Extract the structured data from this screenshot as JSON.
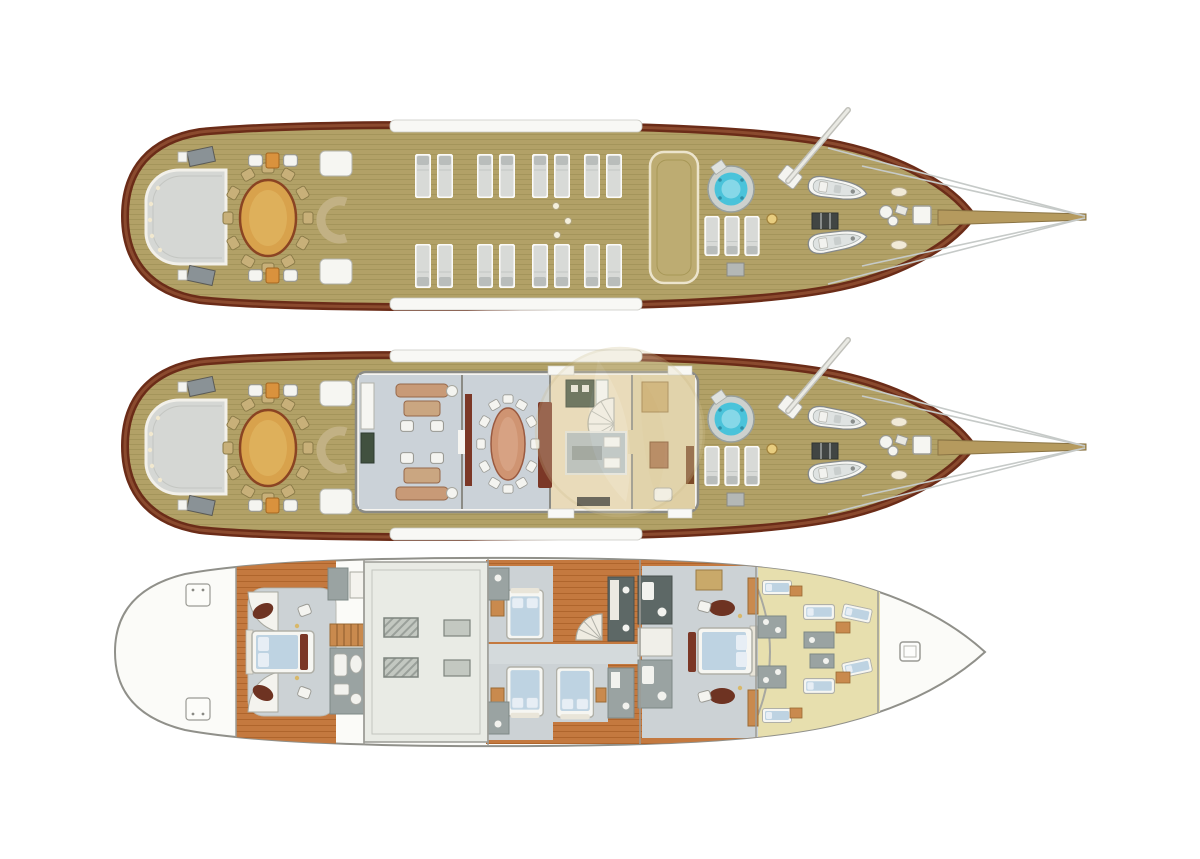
{
  "document": {
    "kind": "yacht-deck-plan-illustration",
    "background": "#ffffff",
    "decks": [
      {
        "id": "sun-deck",
        "features": [
          "stern-sun-pad",
          "alfresco-dining-table",
          "dining-chairs",
          "deck-seating-groups",
          "boarding-pads",
          "sun-lounger-rows",
          "skylight-panel",
          "jacuzzi",
          "sun-pads",
          "windlass-dot",
          "mast",
          "tenders",
          "deck-hatch",
          "bow-windlass",
          "bow-hatch",
          "bowsprit",
          "rigging-lines"
        ]
      },
      {
        "id": "main-deck",
        "features": [
          "stern-sun-pad",
          "alfresco-dining-table",
          "dining-chairs",
          "deck-seating-groups",
          "boarding-pads",
          "salon-lounge",
          "tv-cabinet",
          "interior-dining-table",
          "dining-benches",
          "galley",
          "spiral-staircase",
          "dinette",
          "pantry-lobby",
          "jacuzzi",
          "sun-pads",
          "mast",
          "tenders",
          "deck-hatch",
          "bow-windlass",
          "bowsprit",
          "rigging-lines"
        ]
      },
      {
        "id": "lower-deck",
        "features": [
          "lazarette-hatches",
          "master-cabin",
          "master-bed",
          "master-bathroom",
          "staircase",
          "engine-room",
          "engine-blocks",
          "guest-cabins",
          "guest-beds",
          "guest-bathrooms",
          "spiral-staircase",
          "corridor",
          "vip-cabin",
          "vip-bed",
          "vip-bathrooms",
          "crew-quarters",
          "crew-bunks",
          "crew-bathrooms",
          "forepeak-hatch"
        ]
      }
    ],
    "watermark": "sail-logo"
  },
  "counts": {
    "sun_loungers": 16,
    "dining_chairs_exterior": 12,
    "dining_chairs_interior": 12,
    "tenders_per_deck": 2,
    "jacuzzis": 2,
    "guest_beds": 3,
    "crew_bunks": 6,
    "engine_blocks": 4
  },
  "palette": {
    "teak": "#b2a167",
    "teak_line": "#998a52",
    "hull_trim": "#6b2c18",
    "hull_trim_light": "#8a4a2e",
    "white_structure": "#f6f5f1",
    "outline_gray": "#8b8b85",
    "stern_pad": "#d5d7d4",
    "table_gold": "#d8a24c",
    "table_rim": "#8a4423",
    "chair_tan": "#c8b079",
    "chair_white": "#f4f4f0",
    "accent_orange": "#d9923d",
    "lounger_gray": "#d8dad7",
    "lounger_pillow": "#b9bdbb",
    "jacuzzi_rim": "#ccd1ce",
    "jacuzzi_water": "#4ac3da",
    "jacuzzi_inner": "#90dcea",
    "tender_white": "#f6f6f3",
    "tender_deck": "#dfe3e2",
    "hatch_dark": "#414543",
    "salon_floor": "#cbd2d8",
    "sofa_salmon": "#c89a77",
    "dining_table_salmon": "#cf9472",
    "bench_maroon": "#7b3726",
    "galley_floor": "#e9dab9",
    "counter_green": "#41513f",
    "counter_gray": "#8e9e92",
    "lobby_floor": "#dfcfa4",
    "cabinet_tan": "#c9a96a",
    "hull_fill": "#fbfbf8",
    "hull_outline": "#90908a",
    "wood_floor": "#c4793f",
    "wood_plank_line": "#a2591f",
    "cabin_floor": "#ccd2d5",
    "corridor_floor": "#d4dadc",
    "bed_frame": "#f6f6f2",
    "mattress_blue": "#bed3e2",
    "pillow_blue": "#e7eef5",
    "bath_gray": "#9aa3a2",
    "bath_dark": "#5d6866",
    "engine_floor": "#e9ebe5",
    "engine_block": "#c3c8c1",
    "crew_floor": "#e7dfae",
    "stair_wood": "#c98a4e",
    "maroon_oval": "#6e3322",
    "watermark": "#e9dfbd",
    "rigging": "#c6cac8",
    "mast_white": "#e9e9e3",
    "gold_dot": "#e8cd7f"
  }
}
